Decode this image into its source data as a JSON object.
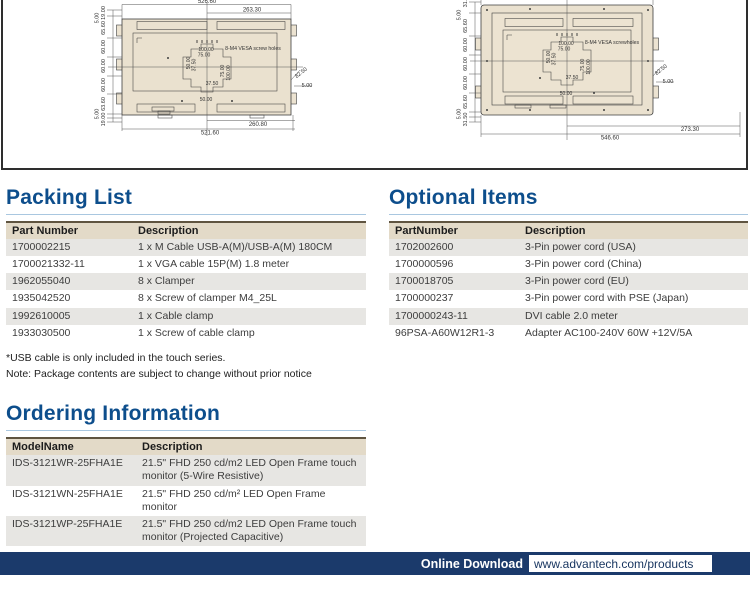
{
  "colors": {
    "heading_blue": "#0d4e8c",
    "heading_rule": "#a9c7e0",
    "footer_navy": "#1b3a6b",
    "table_header_bg": "#e3dac8",
    "table_row_alt": "#e7e6e3",
    "drawing_fill": "#eae1cf"
  },
  "drawings": {
    "left": {
      "labels": [
        {
          "t": "526.60",
          "x": 207,
          "y": 3
        },
        {
          "t": "263.30",
          "x": 252,
          "y": 11.5
        },
        {
          "t": "19.00",
          "x": 105,
          "y": 13,
          "r": -90,
          "s": 5.5
        },
        {
          "t": "5.00",
          "x": 98.5,
          "y": 18,
          "r": -90,
          "s": 5.5
        },
        {
          "t": "65.60",
          "x": 105,
          "y": 28,
          "r": -90,
          "s": 5.5
        },
        {
          "t": "60.00",
          "x": 105,
          "y": 47,
          "r": -90,
          "s": 5.5
        },
        {
          "t": "60.00",
          "x": 105,
          "y": 66,
          "r": -90,
          "s": 5.5
        },
        {
          "t": "60.00",
          "x": 105,
          "y": 85,
          "r": -90,
          "s": 5.5
        },
        {
          "t": "63.60",
          "x": 105,
          "y": 104,
          "r": -90,
          "s": 5.5
        },
        {
          "t": "5.00",
          "x": 98.5,
          "y": 114,
          "r": -90,
          "s": 5.5
        },
        {
          "t": "19.00",
          "x": 105,
          "y": 119.5,
          "r": -90,
          "s": 5.5
        },
        {
          "t": "100.00",
          "x": 206,
          "y": 51,
          "s": 5
        },
        {
          "t": "75.00",
          "x": 204,
          "y": 56.5,
          "s": 5
        },
        {
          "t": "50.00",
          "x": 190,
          "y": 63,
          "r": -90,
          "s": 5
        },
        {
          "t": "37.50",
          "x": 195.5,
          "y": 65,
          "r": -90,
          "s": 5
        },
        {
          "t": "75.00",
          "x": 224,
          "y": 71,
          "r": -90,
          "s": 5
        },
        {
          "t": "100.00",
          "x": 230,
          "y": 73,
          "r": -90,
          "s": 5
        },
        {
          "t": "37.50",
          "x": 212,
          "y": 85,
          "s": 5
        },
        {
          "t": "50.00",
          "x": 206,
          "y": 101,
          "s": 5
        },
        {
          "t": "8-M4 VESA screw holes",
          "x": 253,
          "y": 50,
          "s": 5.2
        },
        {
          "t": "82.50",
          "x": 302,
          "y": 74,
          "r": -38,
          "s": 5.5
        },
        {
          "t": "5.00",
          "x": 307,
          "y": 87,
          "s": 5.5
        },
        {
          "t": "260.80",
          "x": 258,
          "y": 126
        },
        {
          "t": "521.60",
          "x": 210,
          "y": 134.5
        }
      ]
    },
    "right": {
      "labels": [
        {
          "t": "31.5",
          "x": 467,
          "y": 2,
          "r": -90,
          "s": 5.5
        },
        {
          "t": "5.00",
          "x": 460.5,
          "y": 15,
          "r": -90,
          "s": 5.5
        },
        {
          "t": "65.60",
          "x": 467,
          "y": 26,
          "r": -90,
          "s": 5.5
        },
        {
          "t": "60.00",
          "x": 467,
          "y": 45,
          "r": -90,
          "s": 5.5
        },
        {
          "t": "60.00",
          "x": 467,
          "y": 64,
          "r": -90,
          "s": 5.5
        },
        {
          "t": "60.00",
          "x": 467,
          "y": 83,
          "r": -90,
          "s": 5.5
        },
        {
          "t": "65.60",
          "x": 467,
          "y": 102,
          "r": -90,
          "s": 5.5
        },
        {
          "t": "5.00",
          "x": 460.5,
          "y": 114,
          "r": -90,
          "s": 5.5
        },
        {
          "t": "31.50",
          "x": 467,
          "y": 119.5,
          "r": -90,
          "s": 5.5
        },
        {
          "t": "100.00",
          "x": 566,
          "y": 45,
          "s": 5
        },
        {
          "t": "75.00",
          "x": 564,
          "y": 50.5,
          "s": 5
        },
        {
          "t": "50.00",
          "x": 550,
          "y": 57,
          "r": -90,
          "s": 5
        },
        {
          "t": "37.50",
          "x": 555.5,
          "y": 59,
          "r": -90,
          "s": 5
        },
        {
          "t": "75.00",
          "x": 584,
          "y": 65,
          "r": -90,
          "s": 5
        },
        {
          "t": "100.00",
          "x": 590,
          "y": 67,
          "r": -90,
          "s": 5
        },
        {
          "t": "37.50",
          "x": 572,
          "y": 79,
          "s": 5
        },
        {
          "t": "50.00",
          "x": 566,
          "y": 95,
          "s": 5
        },
        {
          "t": "8-M4 VESA screwholes",
          "x": 612,
          "y": 44,
          "s": 5.2
        },
        {
          "t": "82.50",
          "x": 662,
          "y": 71,
          "r": -38,
          "s": 5.5
        },
        {
          "t": "5.00",
          "x": 668,
          "y": 83,
          "s": 5.5
        },
        {
          "t": "273.30",
          "x": 690,
          "y": 131
        },
        {
          "t": "546.60",
          "x": 610,
          "y": 139.5
        }
      ]
    }
  },
  "sections": {
    "packing_list": {
      "title": "Packing List",
      "columns": [
        "Part Number",
        "Description"
      ],
      "rows": [
        [
          "1700002215",
          "1 x M Cable USB-A(M)/USB-A(M) 180CM"
        ],
        [
          "1700021332-11",
          "1 x VGA cable 15P(M) 1.8 meter"
        ],
        [
          "1962055040",
          "8 x Clamper"
        ],
        [
          "1935042520",
          "8 x Screw of clamper M4_25L"
        ],
        [
          "1992610005",
          "1 x Cable clamp"
        ],
        [
          "1933030500",
          "1 x Screw of cable clamp"
        ]
      ],
      "notes": [
        "*USB cable is only included in the touch series.",
        "Note: Package contents are subject to change without prior notice"
      ]
    },
    "optional_items": {
      "title": "Optional Items",
      "columns": [
        "PartNumber",
        "Description"
      ],
      "rows": [
        [
          "1702002600",
          "3-Pin power cord (USA)"
        ],
        [
          "1700000596",
          "3-Pin power cord (China)"
        ],
        [
          "1700018705",
          "3-Pin power cord (EU)"
        ],
        [
          "1700000237",
          "3-Pin power cord with PSE (Japan)"
        ],
        [
          "1700000243-11",
          "DVI cable 2.0 meter"
        ],
        [
          "96PSA-A60W12R1-3",
          "Adapter AC100-240V 60W +12V/5A"
        ]
      ]
    },
    "ordering_information": {
      "title": "Ordering Information",
      "columns": [
        "ModelName",
        "Description"
      ],
      "rows": [
        [
          "IDS-3121WR-25FHA1E",
          "21.5\" FHD 250 cd/m2 LED Open Frame touch monitor (5-Wire Resistive)"
        ],
        [
          "IDS-3121WN-25FHA1E",
          "21.5\" FHD 250 cd/m² LED Open Frame monitor"
        ],
        [
          "IDS-3121WP-25FHA1E",
          "21.5\" FHD 250 cd/m2 LED Open Frame touch monitor (Projected Capacitive)"
        ]
      ]
    }
  },
  "footer": {
    "label": "Online Download",
    "url": "www.advantech.com/products"
  }
}
